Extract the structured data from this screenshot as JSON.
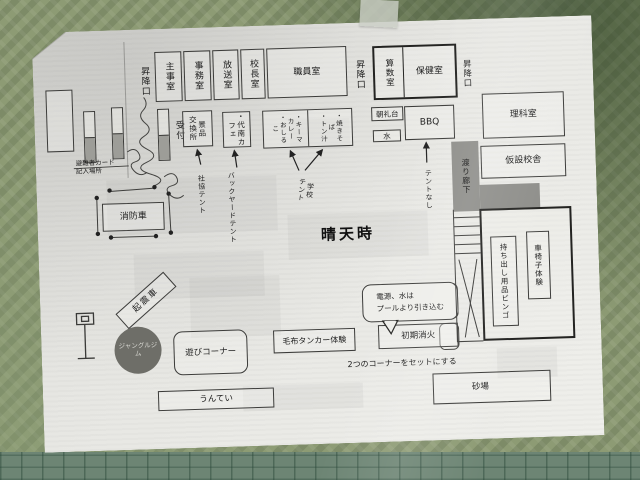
{
  "map": {
    "title": "晴天時",
    "rooms": {
      "entrance_left": "昇降口",
      "caretaker": "主事室",
      "office": "事務室",
      "broadcast": "放送室",
      "principal": "校長室",
      "staff": "職員室",
      "entrance_mid": "昇降口",
      "math": "算数室",
      "health": "保健室",
      "entrance_right": "昇降口",
      "science": "理科室",
      "temp_building": "仮設校舎",
      "corridor": "渡り廊下"
    },
    "reception": {
      "label": "受付",
      "card_note": "避難者カード\n記入場所"
    },
    "stalls": {
      "prize_exchange": "景品\n交換所",
      "cafe": "・代南カ\nフェ",
      "food_left": "・キーマ\nカレー\n・おしるこ",
      "food_right": "・焼きそば\n・トン汁",
      "platform": "朝礼台",
      "water": "水",
      "bbq": "BBQ"
    },
    "tents": {
      "shakyo": "社協テント",
      "backyard": "バックヤードテント",
      "school": "学校\nテント",
      "none": "テントなし"
    },
    "corners": {
      "fire_truck": "消防車",
      "quake_truck": "起震車",
      "bingo": "持ち出し用品ビンゴ",
      "wheelchair": "車椅子体験",
      "blanket_stretcher": "毛布タンカー体験",
      "fire_extinguish": "初期消火",
      "set_note": "2つのコーナーをセットにする",
      "power_note": "電源、水は\nプールより引き込む"
    },
    "playground": {
      "play_corner": "遊びコーナー",
      "jungle_gym": "ジャングルジム",
      "monkey_bars": "うんてい",
      "sandbox": "砂場"
    }
  }
}
